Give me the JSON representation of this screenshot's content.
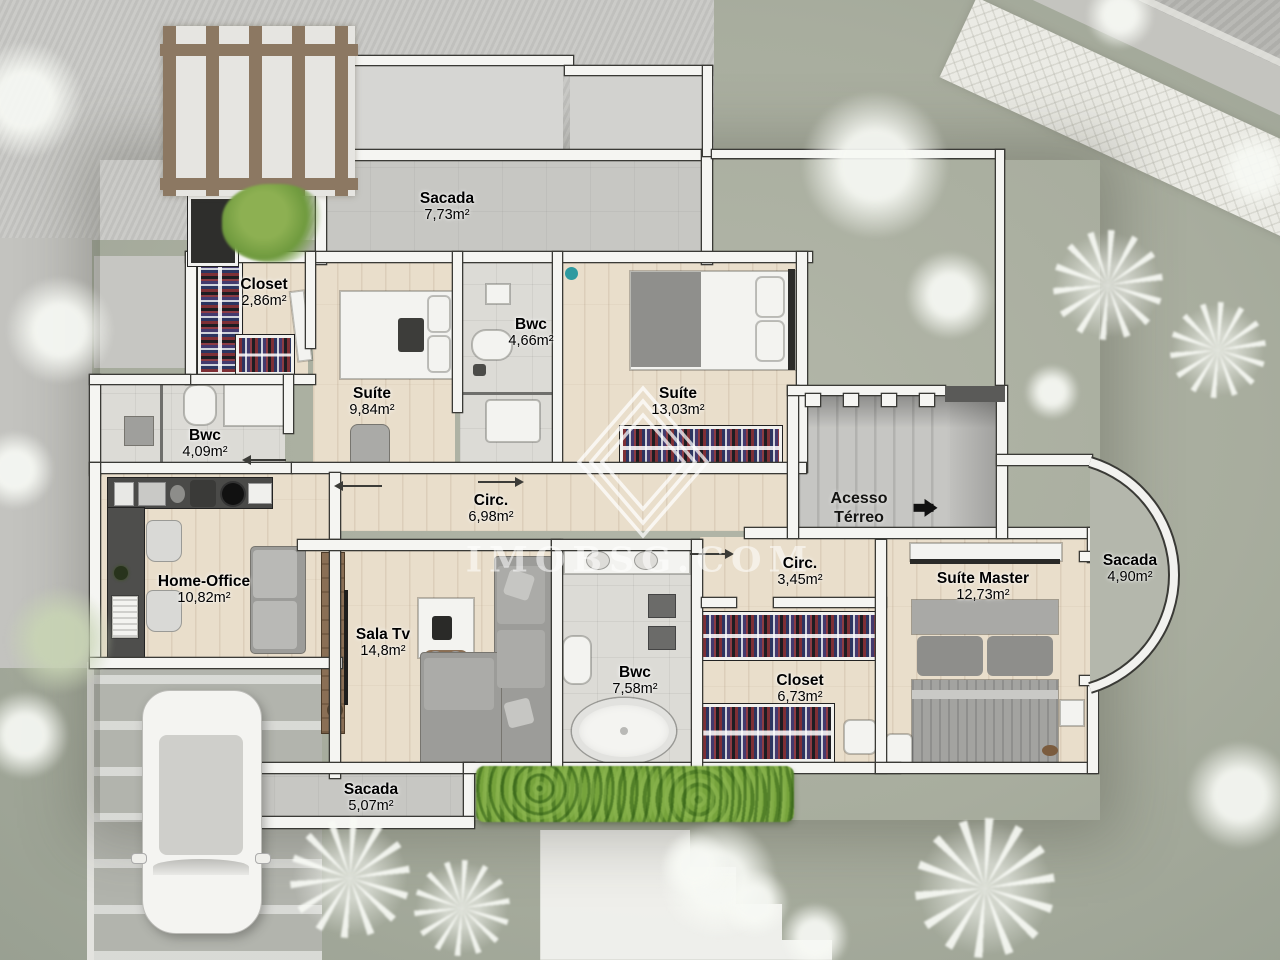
{
  "watermark": {
    "text": "IMOBSG.COM"
  },
  "access": {
    "line1": "Acesso",
    "line2": "Térreo"
  },
  "rooms": [
    {
      "id": "sacada-top",
      "name": "Sacada",
      "area": "7,73m²"
    },
    {
      "id": "closet-1",
      "name": "Closet",
      "area": "2,86m²"
    },
    {
      "id": "suite-1",
      "name": "Suíte",
      "area": "9,84m²"
    },
    {
      "id": "bwc-1",
      "name": "Bwc",
      "area": "4,66m²"
    },
    {
      "id": "suite-2",
      "name": "Suíte",
      "area": "13,03m²"
    },
    {
      "id": "bwc-2",
      "name": "Bwc",
      "area": "4,09m²"
    },
    {
      "id": "circ-1",
      "name": "Circ.",
      "area": "6,98m²"
    },
    {
      "id": "circ-2",
      "name": "Circ.",
      "area": "3,45m²"
    },
    {
      "id": "sacada-right",
      "name": "Sacada",
      "area": "4,90m²"
    },
    {
      "id": "home-office",
      "name": "Home-Office",
      "area": "10,82m²"
    },
    {
      "id": "suite-master",
      "name": "Suíte Master",
      "area": "12,73m²"
    },
    {
      "id": "sala-tv",
      "name": "Sala Tv",
      "area": "14,8m²"
    },
    {
      "id": "bwc-3",
      "name": "Bwc",
      "area": "7,58m²"
    },
    {
      "id": "closet-2",
      "name": "Closet",
      "area": "6,73m²"
    },
    {
      "id": "sacada-bottom",
      "name": "Sacada",
      "area": "5,07m²"
    }
  ]
}
